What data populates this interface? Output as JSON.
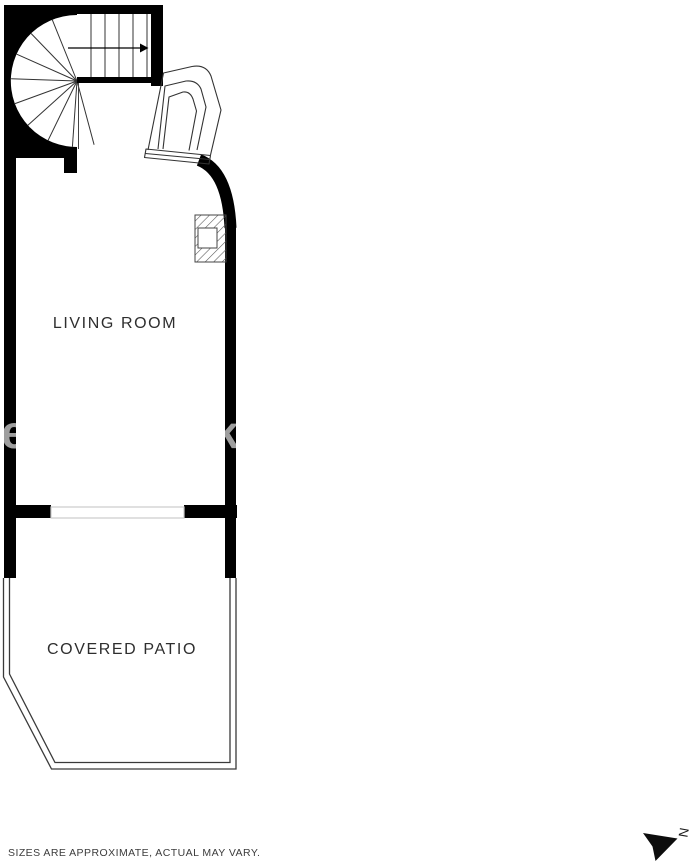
{
  "floor_plan": {
    "type": "residential floor plan",
    "rooms": [
      {
        "name": "LIVING ROOM"
      },
      {
        "name": "COVERED PATIO"
      }
    ],
    "features": [
      "spiral-staircase",
      "straight-stair-run",
      "stair-direction-arrow",
      "entry-door",
      "fireplace",
      "sliding-glass-door",
      "patio-outline"
    ]
  },
  "labels": {
    "living_room": "LIVING ROOM",
    "covered_patio": "COVERED PATIO"
  },
  "footer": {
    "disclaimer": "SIZES ARE APPROXIMATE, ACTUAL MAY VARY."
  },
  "compass": {
    "label": "N"
  },
  "watermark": {
    "left_fragment": "e",
    "right_fragment": "k"
  },
  "colors": {
    "wall": "#000000",
    "thin_line": "#333333",
    "hatch_line": "#555555",
    "window_line": "#cccccc",
    "text": "#2e2e2e",
    "disclaimer_text": "#3c3c3c",
    "watermark_gray": "#9e9e9e",
    "background": "#ffffff"
  }
}
